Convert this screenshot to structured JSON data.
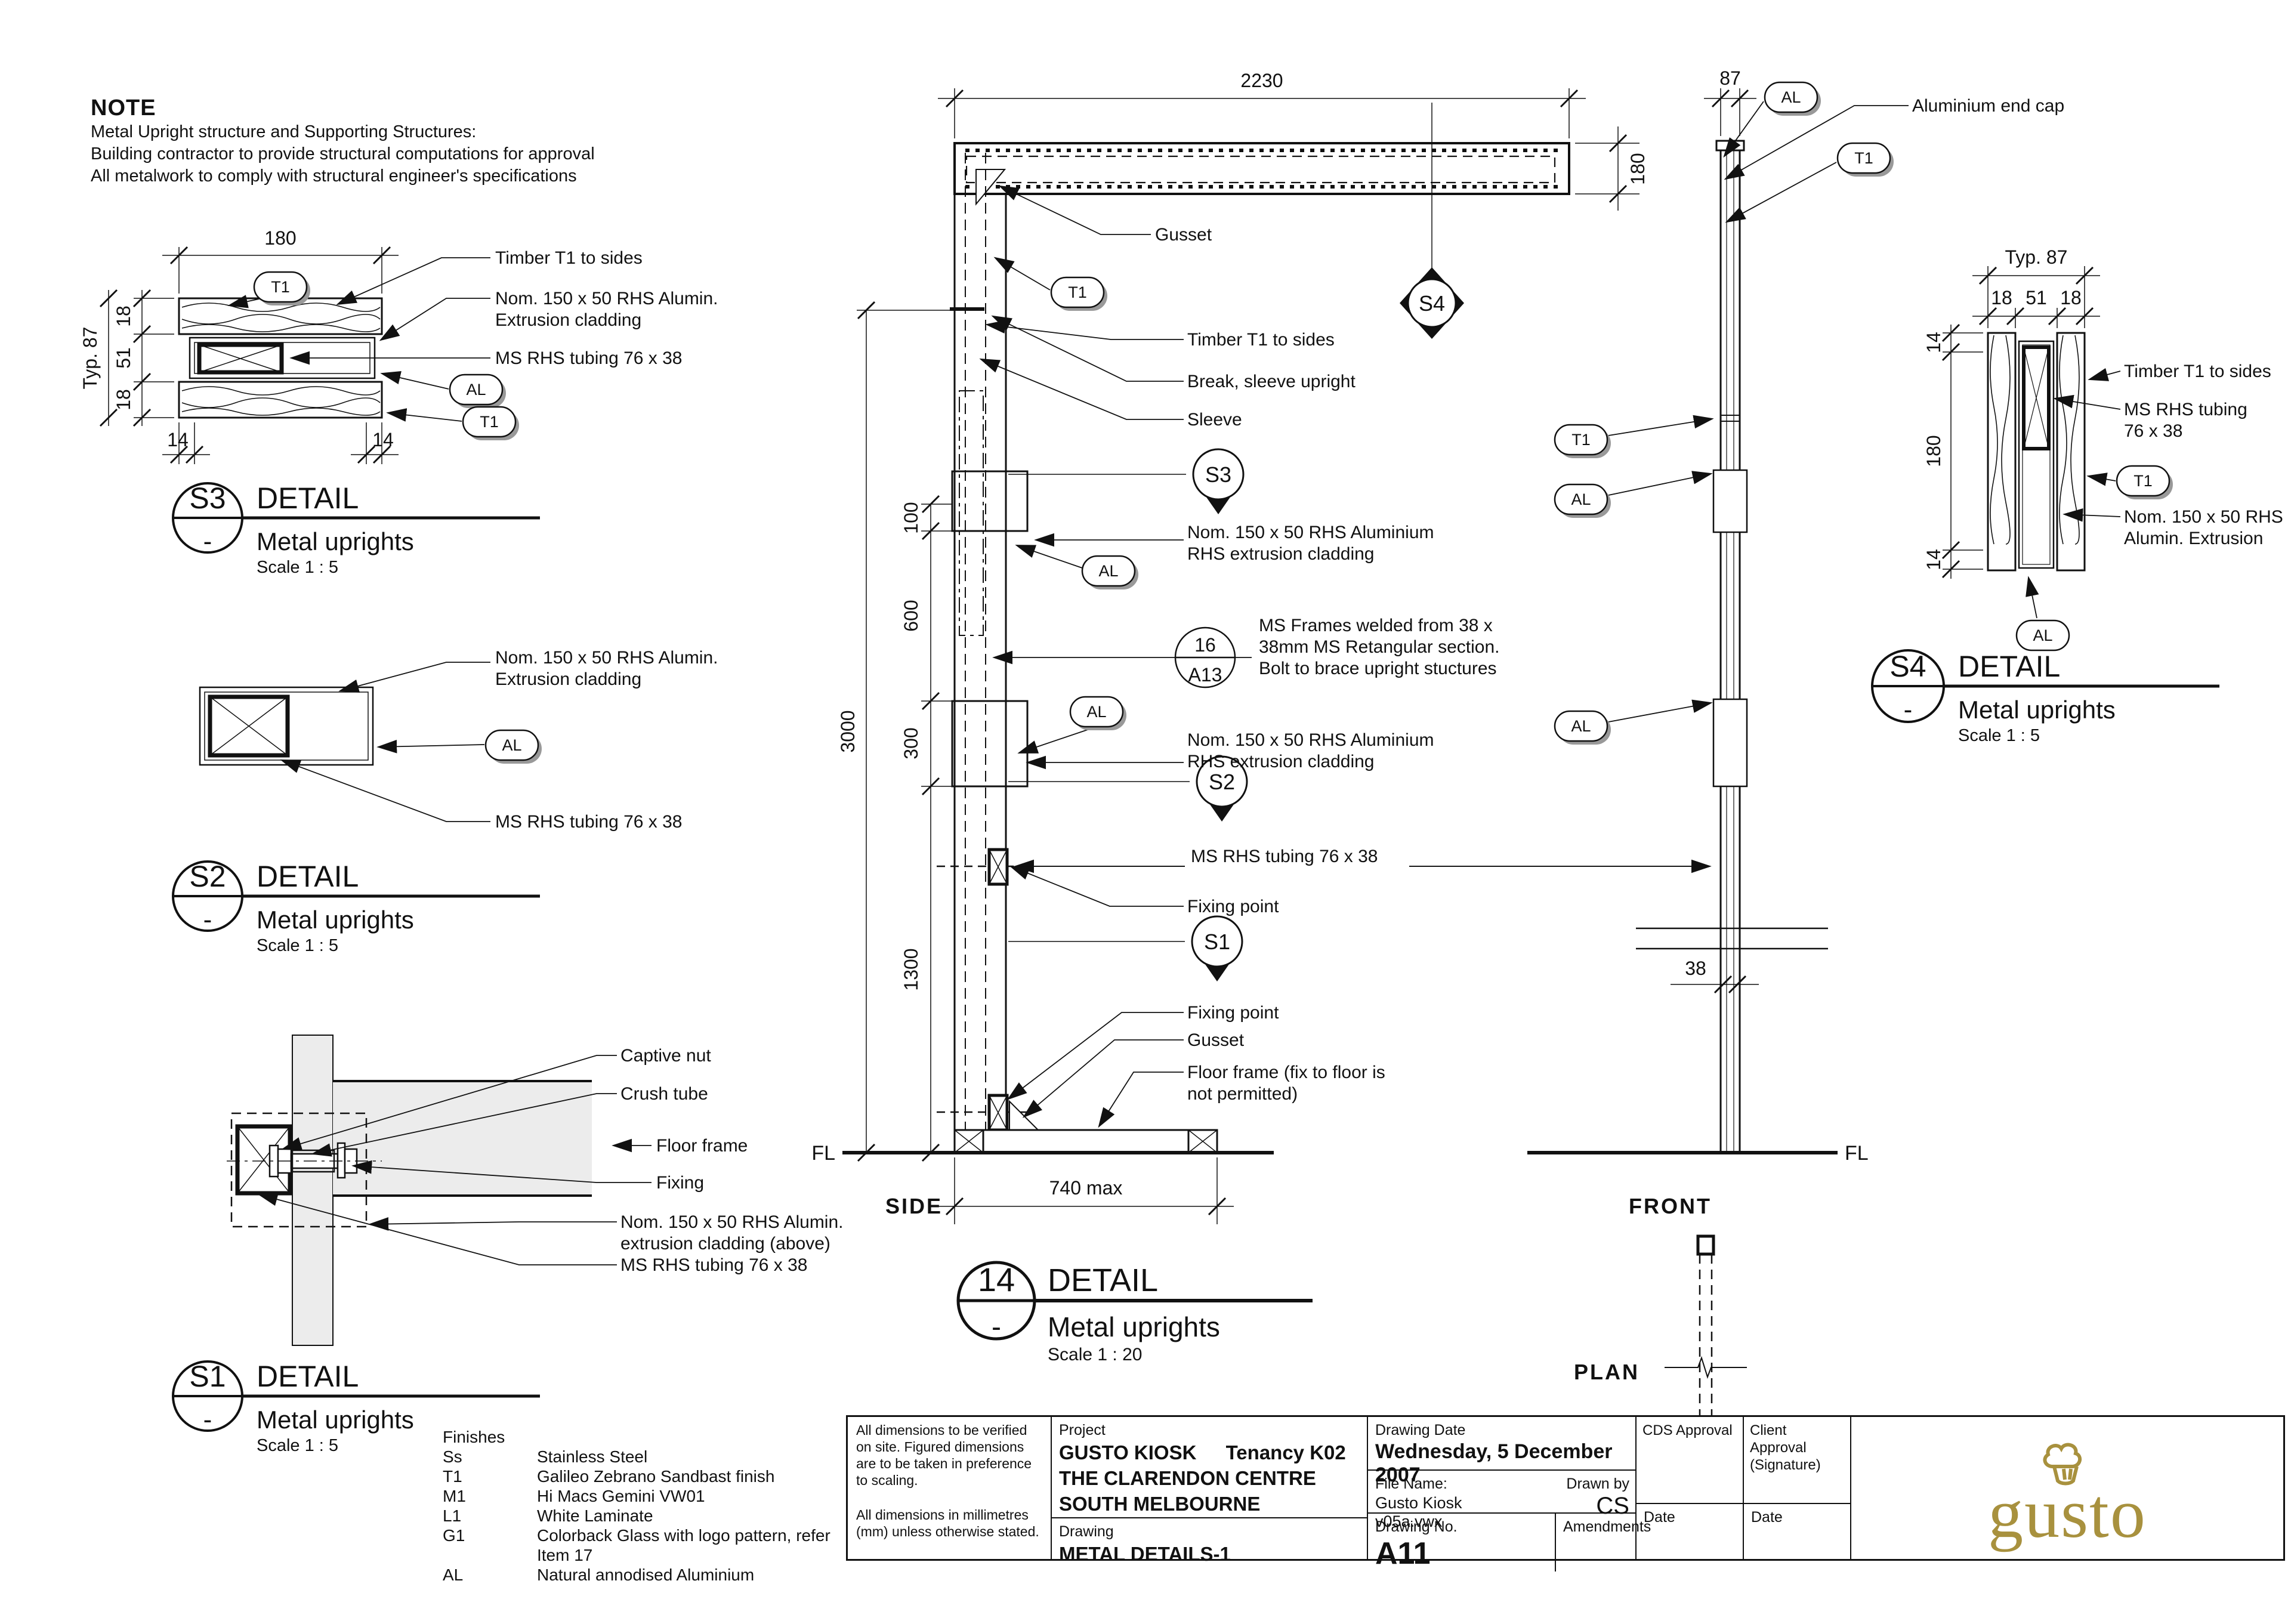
{
  "note": {
    "title": "NOTE",
    "line1": "Metal Upright structure and Supporting Structures:",
    "line2": "Building contractor to provide structural computations for approval",
    "line3": "All metalwork to comply with structural engineer's specifications"
  },
  "tags": {
    "t1": "T1",
    "al": "AL"
  },
  "markers": {
    "s1": "S1",
    "s2": "S2",
    "s3": "S3",
    "s4": "S4",
    "ref_num": "16",
    "ref_sheet": "A13"
  },
  "views": {
    "side": "SIDE",
    "front": "FRONT",
    "plan": "PLAN",
    "fl": "FL"
  },
  "dims": {
    "d2230": "2230",
    "d180": "180",
    "d87": "87",
    "d100": "100",
    "d600": "600",
    "d300": "300",
    "d1300": "1300",
    "d3000": "3000",
    "d740": "740 max",
    "d38": "38",
    "typ87": "Typ. 87",
    "d18": "18",
    "d51": "51",
    "d14": "14"
  },
  "labels": {
    "gusset": "Gusset",
    "timber_t1": "Timber T1 to sides",
    "break_sleeve": "Break, sleeve upright",
    "sleeve": "Sleeve",
    "alum_clad_1": "Nom. 150 x 50 RHS Aluminium",
    "alum_clad_2": "RHS extrusion cladding",
    "ms_frames_1": "MS Frames welded from 38 x",
    "ms_frames_2": "38mm MS Retangular section.",
    "ms_frames_3": "Bolt to brace upright stuctures",
    "ms_rhs": "MS RHS tubing 76 x 38",
    "fixing_point": "Fixing point",
    "floor_frame_note_1": "Floor frame (fix to floor is",
    "floor_frame_note_2": "not permitted)",
    "alum_end_cap": "Aluminium end cap",
    "captive_nut": "Captive nut",
    "crush_tube": "Crush tube",
    "floor_frame": "Floor frame",
    "fixing": "Fixing",
    "clad_above_1": "Nom. 150 x 50 RHS Alumin.",
    "clad_above_2": "extrusion cladding (above)",
    "alumin_clad_1": "Nom. 150 x 50 RHS Alumin.",
    "alumin_clad_2": "Extrusion cladding",
    "ms_rhs_2l_1": "MS RHS tubing",
    "ms_rhs_2l_2": "76 x 38",
    "rhs_alumin_1": "Nom. 150 x 50 RHS",
    "rhs_alumin_2": "Alumin. Extrusion"
  },
  "detail_titles": {
    "s3": {
      "id": "S3",
      "dash": "-",
      "heading": "DETAIL",
      "name": "Metal uprights",
      "scale": "Scale  1 : 5"
    },
    "s2": {
      "id": "S2",
      "dash": "-",
      "heading": "DETAIL",
      "name": "Metal uprights",
      "scale": "Scale  1 : 5"
    },
    "s1": {
      "id": "S1",
      "dash": "-",
      "heading": "DETAIL",
      "name": "Metal uprights",
      "scale": "Scale  1 : 5"
    },
    "s4": {
      "id": "S4",
      "dash": "-",
      "heading": "DETAIL",
      "name": "Metal uprights",
      "scale": "Scale  1 : 5"
    },
    "d14": {
      "id": "14",
      "dash": "-",
      "heading": "DETAIL",
      "name": "Metal uprights",
      "scale": "Scale  1 : 20"
    }
  },
  "finishes": {
    "title": "Finishes",
    "items": [
      {
        "code": "Ss",
        "desc": "Stainless Steel"
      },
      {
        "code": "T1",
        "desc": "Galileo Zebrano Sandbast finish"
      },
      {
        "code": "M1",
        "desc": "Hi Macs Gemini VW01"
      },
      {
        "code": "L1",
        "desc": "White Laminate"
      },
      {
        "code": "G1",
        "desc": "Colorback Glass with logo pattern, refer Item 17"
      },
      {
        "code": "AL",
        "desc": "Natural annodised Aluminium"
      }
    ]
  },
  "titleblock": {
    "notes1": "All dimensions to be verified on site. Figured dimensions are to be taken in preference to scaling.",
    "notes2": "All dimensions in millimetres (mm) unless otherwise stated.",
    "project_label": "Project",
    "project_line1a": "GUSTO KIOSK",
    "project_line1b": "Tenancy K02",
    "project_line2": "THE CLARENDON CENTRE",
    "project_line3": "SOUTH MELBOURNE",
    "drawing_label": "Drawing",
    "drawing_title": "METAL DETAILS-1",
    "date_label": "Drawing Date",
    "date_value": "Wednesday, 5 December 2007",
    "file_label": "File Name:",
    "file_value": "Gusto Kiosk v05a.vwx",
    "drawnby_label": "Drawn by",
    "drawnby_value": "CS",
    "dwgno_label": "Drawing No.",
    "dwgno_value": "A11",
    "amendments_label": "Amendments",
    "date_col_label": "Date",
    "cds_label1": "CDS Approval",
    "cds_label2": "(Signature)",
    "client_label1": "Client Approval",
    "client_label2": "(Signature)",
    "logo_text": "gusto",
    "logo_color": "#A8913E"
  }
}
